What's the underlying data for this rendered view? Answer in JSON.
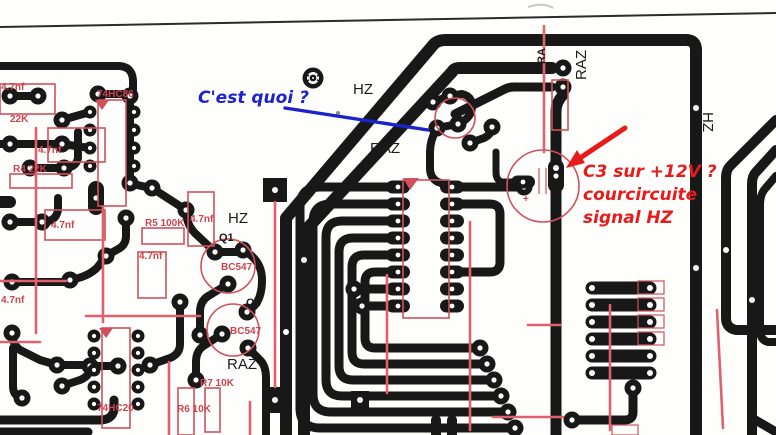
{
  "annotations": {
    "blue_note": "C'est quoi ?",
    "red_note_line1": "C3 sur +12V ?",
    "red_note_line2": "courcircuite",
    "red_note_line3": "signal HZ"
  },
  "net_labels": {
    "hz_top": "HZ",
    "raz_mid": "RAZ",
    "hz_left": "HZ",
    "raz_bottom": "RAZ",
    "raz_vertical": "RAZ",
    "ra_vertical": "RA",
    "hz_right_vertical": "HZ"
  },
  "components": {
    "ic1": "74HC86",
    "ic2": "74HC20",
    "q1": "Q1",
    "q1_type": "BC547",
    "q2": "Q2",
    "q2_type": "BC547",
    "r_top": "22K",
    "r4": "R4 22K",
    "r5": "R5 100K",
    "r6": "R6 10K",
    "r7": "R7 10K",
    "cap_a": "4.7nf",
    "cap_b": "4.7nf",
    "cap_c": "4.7nf",
    "cap_d": "4.7nf",
    "cap_e": "4.7nf",
    "cap_f": "4.7nf",
    "cap_plus": "+"
  },
  "colors": {
    "trace": "#181818",
    "silkscreen_red": "#d0515d",
    "annotation_blue": "#1c22cc",
    "annotation_red": "#e81b1b"
  }
}
